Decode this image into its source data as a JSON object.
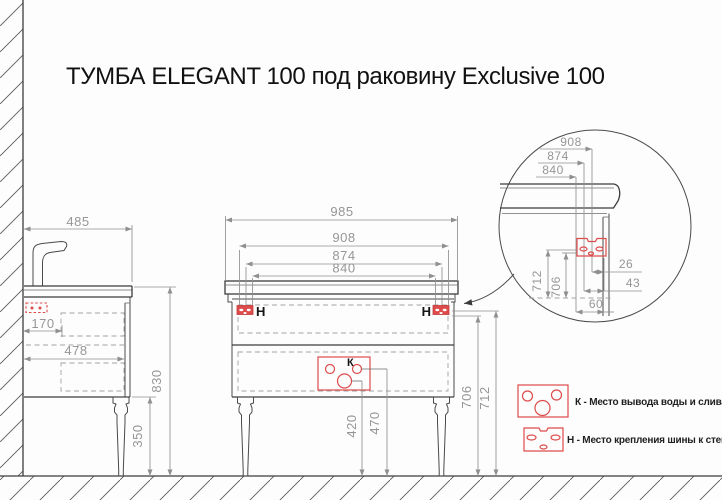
{
  "title": "ТУМБА ELEGANT 100 под раковину Exclusive 100",
  "side_view": {
    "countertop_depth": "485",
    "outlet_offset": "170",
    "cabinet_depth": "478",
    "total_height": "830",
    "leg_height": "350"
  },
  "front_view": {
    "countertop_width": "985",
    "rail_width": "908",
    "holes_width_mid": "874",
    "holes_width_inner": "840",
    "rail_label_left": "H",
    "rail_label_right": "H",
    "outlet_label": "К",
    "drain_height": "420",
    "supply_height": "470",
    "rail_bottom_height": "706",
    "rail_top_height": "712"
  },
  "detail_view": {
    "rail_width": "908",
    "holes_width_mid": "874",
    "holes_width_inner": "840",
    "edge_offset_rail": "26",
    "edge_offset_mid": "43",
    "edge_offset_inner": "60",
    "rail_top_height": "712",
    "rail_bottom_height": "706"
  },
  "legend": {
    "k_text": "К - Место вывода воды и слива",
    "h_text": "Н - Место крепления шины к стене"
  },
  "colors": {
    "accent_red": "#dd4b4b",
    "line": "#3c3c3c",
    "dim_text": "#969696"
  }
}
